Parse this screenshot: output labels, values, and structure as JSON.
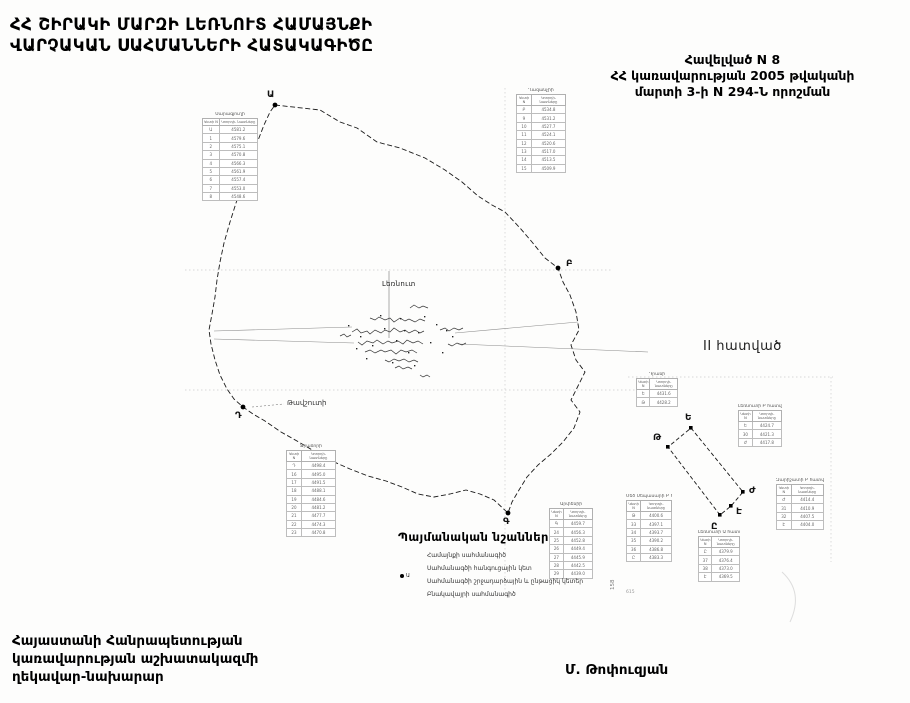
{
  "title": {
    "line1": "ՀՀ ՇԻՐԱԿԻ ՄԱՐԶԻ ԼԵՌՆՈՒՏ ՀԱՄԱՅՆՔԻ",
    "line2": "ՎԱՐՉԱԿԱՆ ՍԱՀՄԱՆՆԵՐԻ ՀԱՏԱԿԱԳԻԾԸ"
  },
  "annex": {
    "line1": "Հավելված  N 8",
    "line2": "ՀՀ կառավարության 2005 թվականի",
    "line3": "մարտի 3-ի N 294-Ն որոշման"
  },
  "map": {
    "settlement_label": "Լեռնուտ",
    "neighbor_label": "Թավշուտի",
    "points": [
      {
        "label": "Ա"
      },
      {
        "label": "Բ"
      },
      {
        "label": "Գ"
      },
      {
        "label": "Դ"
      }
    ]
  },
  "section2": {
    "heading": "II հատված",
    "points": [
      {
        "label": "Ե"
      },
      {
        "label": "Թ"
      },
      {
        "label": "Ժ"
      },
      {
        "label": "Է"
      },
      {
        "label": "Ը"
      }
    ]
  },
  "legend": {
    "title": "Պայմանական նշաններ",
    "node_letter": "Ա",
    "items": [
      {
        "label": "Համայնքի սահմանագիծ"
      },
      {
        "label": "Սահմանագծի հանգուցային կետ"
      },
      {
        "label": "Սահմանագծի շրջադարձային և ընթացիկ կետեր"
      },
      {
        "label": "Բնակավայրի սահմանագիծ"
      }
    ]
  },
  "signature": {
    "line1": "Հայաստանի Հանրապետության",
    "line2": "կառավարության աշխատակազմի",
    "line3": "ղեկավար-նախարար",
    "name": "Մ. Թոփուզյան"
  },
  "artifacts": {
    "num1": "158",
    "num2": "615"
  },
  "table_header": {
    "col1": "Կետի N",
    "col2": "Կոորդի- նատները"
  },
  "mini_tables": [
    {
      "title": "Սարագյուղի",
      "rows": [
        [
          "Ա",
          "4581.2"
        ],
        [
          "1",
          "4579.6"
        ],
        [
          "2",
          "4575.1"
        ],
        [
          "3",
          "4570.8"
        ],
        [
          "4",
          "4566.3"
        ],
        [
          "5",
          "4561.9"
        ],
        [
          "6",
          "4557.4"
        ],
        [
          "7",
          "4553.0"
        ],
        [
          "8",
          "4548.6"
        ]
      ]
    },
    {
      "title": "Ղազանչիի",
      "rows": [
        [
          "Բ",
          "4534.8"
        ],
        [
          "9",
          "4531.2"
        ],
        [
          "10",
          "4527.7"
        ],
        [
          "11",
          "4524.1"
        ],
        [
          "12",
          "4520.6"
        ],
        [
          "13",
          "4517.0"
        ],
        [
          "14",
          "4513.5"
        ],
        [
          "15",
          "4509.9"
        ]
      ]
    },
    {
      "title": "Ջրաձորի",
      "rows": [
        [
          "Դ",
          "4498.4"
        ],
        [
          "16",
          "4495.0"
        ],
        [
          "17",
          "4491.5"
        ],
        [
          "18",
          "4488.1"
        ],
        [
          "19",
          "4484.6"
        ],
        [
          "20",
          "4481.2"
        ],
        [
          "21",
          "4477.7"
        ],
        [
          "22",
          "4474.3"
        ],
        [
          "23",
          "4470.8"
        ]
      ]
    },
    {
      "title": "Արփենիի",
      "rows": [
        [
          "Գ",
          "4459.7"
        ],
        [
          "24",
          "4456.3"
        ],
        [
          "25",
          "4452.8"
        ],
        [
          "26",
          "4449.4"
        ],
        [
          "27",
          "4445.9"
        ],
        [
          "28",
          "4442.5"
        ],
        [
          "29",
          "4439.0"
        ]
      ]
    },
    {
      "title": "Դրանի",
      "rows": [
        [
          "Ե",
          "4431.6"
        ],
        [
          "Թ",
          "4428.2"
        ]
      ]
    },
    {
      "title": "Լեռնուտի Բ հատված",
      "rows": [
        [
          "Ե",
          "4424.7"
        ],
        [
          "30",
          "4421.3"
        ],
        [
          "Ժ",
          "4417.8"
        ]
      ]
    },
    {
      "title": "Զարիշատի Բ հատված",
      "rows": [
        [
          "Ժ",
          "4414.4"
        ],
        [
          "31",
          "4410.9"
        ],
        [
          "32",
          "4407.5"
        ],
        [
          "Է",
          "4404.0"
        ]
      ]
    },
    {
      "title": "Մեծ Սեպասարի Բ հատված",
      "rows": [
        [
          "Թ",
          "4400.6"
        ],
        [
          "33",
          "4397.1"
        ],
        [
          "34",
          "4393.7"
        ],
        [
          "35",
          "4390.2"
        ],
        [
          "36",
          "4386.8"
        ],
        [
          "Ը",
          "4383.3"
        ]
      ]
    },
    {
      "title": "Լեռնուտի Ա հատված",
      "rows": [
        [
          "Ը",
          "4379.9"
        ],
        [
          "37",
          "4376.4"
        ],
        [
          "38",
          "4373.0"
        ],
        [
          "Է",
          "4369.5"
        ]
      ]
    }
  ]
}
